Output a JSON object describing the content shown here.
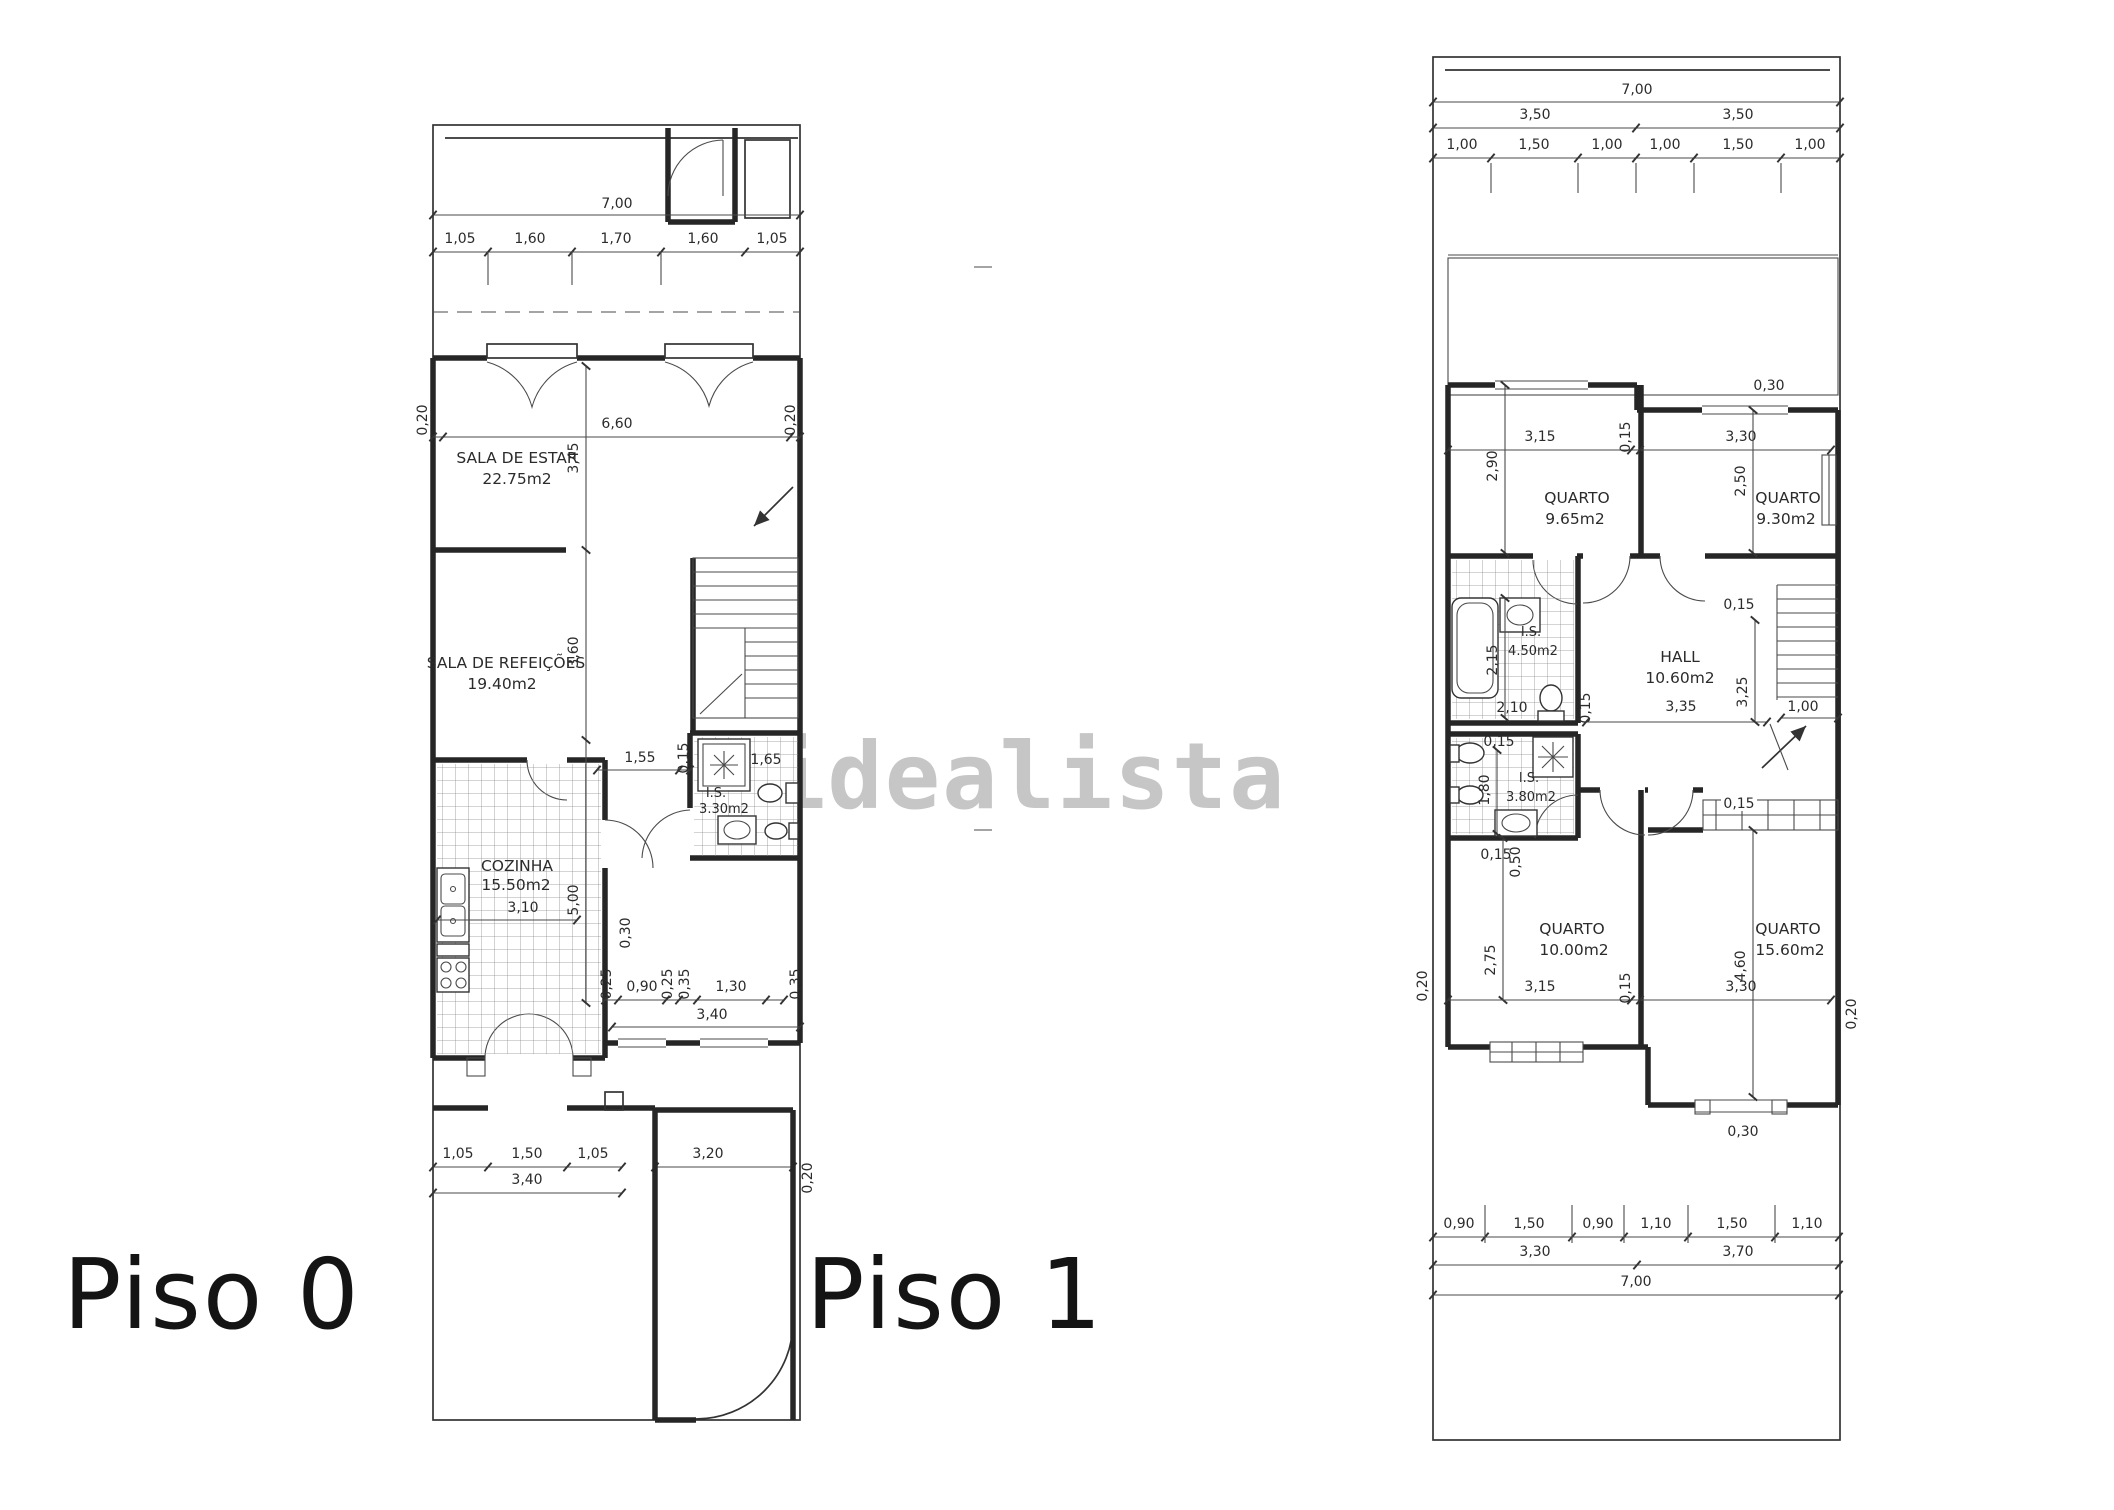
{
  "watermark": {
    "text": "idealista"
  },
  "floor0": {
    "title": "Piso 0",
    "rooms": {
      "estar": {
        "name": "SALA DE ESTAR",
        "area": "22.75m2"
      },
      "refeicoes": {
        "name": "SALA DE REFEIÇÕES",
        "area": "19.40m2"
      },
      "cozinha": {
        "name": "COZINHA",
        "area": "15.50m2"
      },
      "wc": {
        "name": "I.S.",
        "area": "3.30m2"
      }
    },
    "dims": {
      "total_w": "7,00",
      "top": [
        "1,05",
        "1,60",
        "1,70",
        "1,60",
        "1,05"
      ],
      "interior_w": "6,60",
      "wall": "0,20",
      "estar_h": "3,45",
      "refeicoes_h": "3,60",
      "cozinha_h": "5,00",
      "cozinha_w": "3,10",
      "hall_w": "1,55",
      "wc_w": "1,65",
      "d015": "0,15",
      "d030": "0,30",
      "d025": "0,25",
      "d090": "0,90",
      "d035": "0,35",
      "d130": "1,30",
      "rear_w": "3,40",
      "patio": [
        "1,05",
        "1,50",
        "1,05"
      ],
      "patio_total": "3,40",
      "garage_w": "3,20"
    }
  },
  "floor1": {
    "title": "Piso 1",
    "rooms": {
      "q1": {
        "name": "QUARTO",
        "area": "9.65m2"
      },
      "q2": {
        "name": "QUARTO",
        "area": "9.30m2"
      },
      "wc1": {
        "name": "I.S.",
        "area": "4.50m2"
      },
      "hall": {
        "name": "HALL",
        "area": "10.60m2"
      },
      "wc2": {
        "name": "I.S.",
        "area": "3.80m2"
      },
      "q3": {
        "name": "QUARTO",
        "area": "10.00m2"
      },
      "q4": {
        "name": "QUARTO",
        "area": "15.60m2"
      }
    },
    "dims": {
      "total_w": "7,00",
      "halves": [
        "3,50",
        "3,50"
      ],
      "top": [
        "1,00",
        "1,50",
        "1,00",
        "1,00",
        "1,50",
        "1,00"
      ],
      "d030": "0,30",
      "q1_w": "3,15",
      "q1_h": "2,90",
      "q2_w": "3,30",
      "q2_h": "2,50",
      "wc1_h": "2,15",
      "wc1_w": "2,10",
      "hall_w": "3,35",
      "hall_h": "3,25",
      "d100": "1,00",
      "wc2_h": "1,80",
      "d050": "0,50",
      "q3_w": "3,15",
      "q3_h": "2,75",
      "q4_w": "3,30",
      "q4_h": "4,60",
      "d015": "0,15",
      "d020": "0,20",
      "bottom": [
        "0,90",
        "1,50",
        "0,90",
        "1,10",
        "1,50",
        "1,10"
      ],
      "bottom_halves": [
        "3,30",
        "3,70"
      ]
    }
  }
}
